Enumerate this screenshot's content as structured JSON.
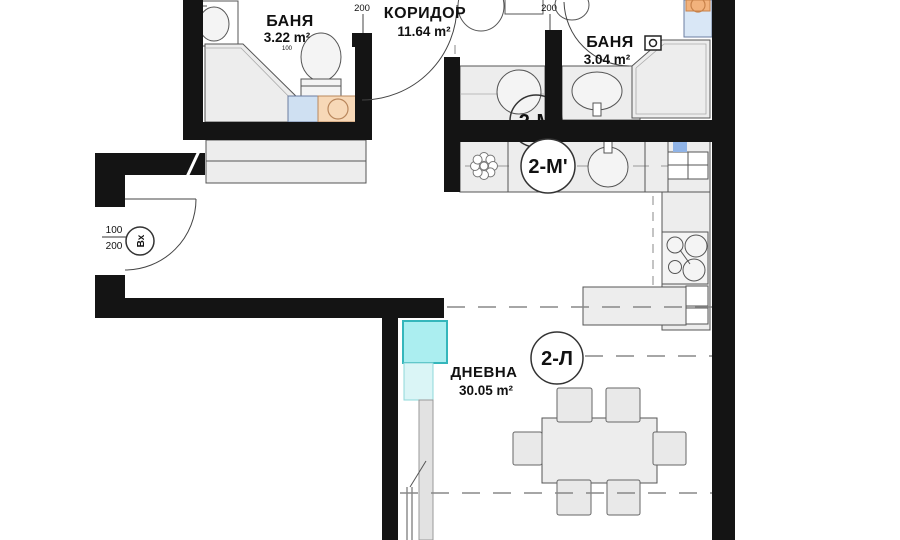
{
  "rooms": {
    "bath1": {
      "name": "БАНЯ",
      "area": "3.22 m²",
      "door_width": "100"
    },
    "corridor": {
      "name": "КОРИДОР",
      "area": "11.64 m²"
    },
    "bath2": {
      "name": "БАНЯ",
      "area": "3.04 m²"
    },
    "living": {
      "name": "ДНЕВНА",
      "area": "30.05 m²"
    }
  },
  "unit_labels": {
    "upper": "2-М",
    "kitchen": "2-М'",
    "living": "2-Л"
  },
  "entrance": {
    "label": "Вх",
    "width": "100",
    "height": "200"
  },
  "door_dims": {
    "bath1": "200",
    "bath2": "200"
  },
  "colors": {
    "wall": "#141414",
    "fixture": "#ededed",
    "cyan_box": "#abeef0",
    "cyan_box_border": "#35b6bb",
    "cyan_strip": "#daf5f6",
    "washer_orange": "#f7d8b7",
    "washer_orange2": "#f2b27c",
    "cabinet_blue": "#cfe0f2",
    "washer_blue": "#d9e7f6",
    "window_blue": "#8fb3e6",
    "annotation": "#333333"
  }
}
